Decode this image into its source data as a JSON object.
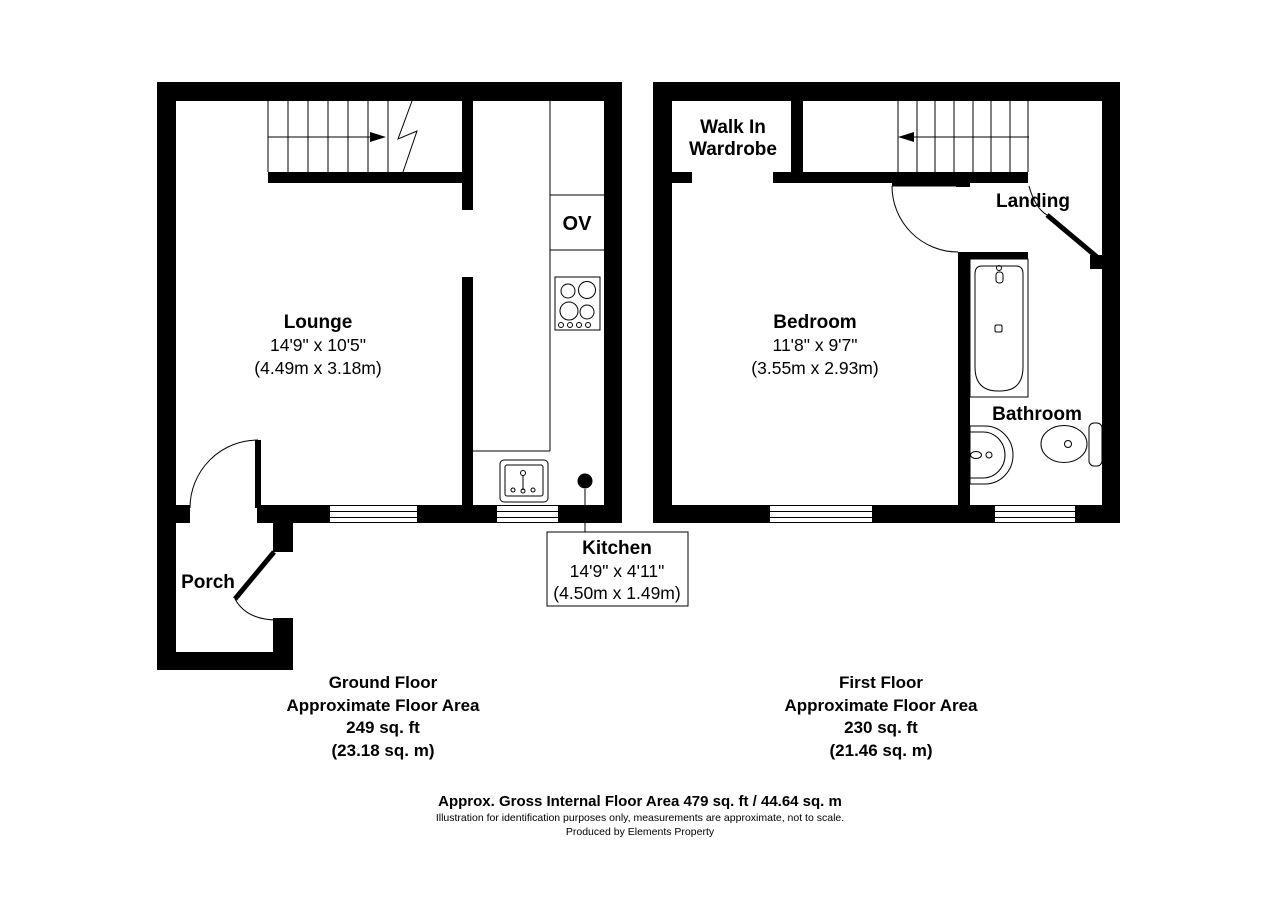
{
  "colors": {
    "wall": "#000000",
    "background": "#ffffff"
  },
  "ground_floor": {
    "stairs_direction": "right",
    "oven_label": "OV",
    "lounge": {
      "name": "Lounge",
      "dims_ft": "14'9\" x 10'5\"",
      "dims_m": "(4.49m x 3.18m)"
    },
    "porch": {
      "name": "Porch"
    },
    "kitchen": {
      "name": "Kitchen",
      "dims_ft": "14'9\" x 4'11\"",
      "dims_m": "(4.50m x 1.49m)"
    },
    "area": {
      "line1": "Ground Floor",
      "line2": "Approximate Floor Area",
      "line3": "249 sq. ft",
      "line4": "(23.18 sq. m)"
    }
  },
  "first_floor": {
    "stairs_direction": "left",
    "wardrobe": {
      "line1": "Walk In",
      "line2": "Wardrobe"
    },
    "landing": {
      "name": "Landing"
    },
    "bedroom": {
      "name": "Bedroom",
      "dims_ft": "11'8\" x 9'7\"",
      "dims_m": "(3.55m x 2.93m)"
    },
    "bathroom": {
      "name": "Bathroom"
    },
    "area": {
      "line1": "First Floor",
      "line2": "Approximate Floor Area",
      "line3": "230 sq. ft",
      "line4": "(21.46 sq. m)"
    }
  },
  "footer": {
    "gross": "Approx. Gross Internal Floor Area 479 sq. ft / 44.64 sq. m",
    "disclaimer": "Illustration for identification purposes only, measurements are approximate, not to scale.",
    "producer": "Produced by Elements Property"
  }
}
